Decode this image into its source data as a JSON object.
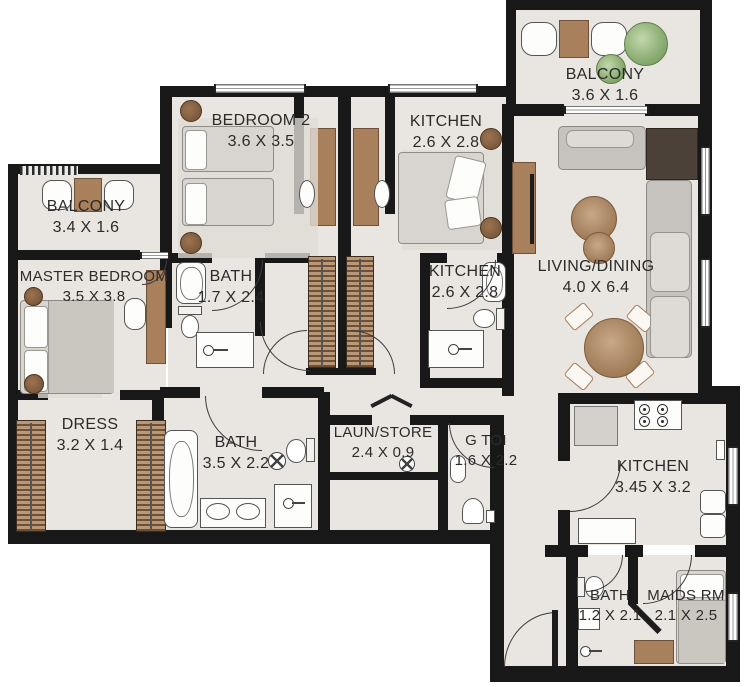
{
  "rooms": {
    "balcony_top": {
      "name": "BALCONY",
      "dims": "3.6 X 1.6"
    },
    "bedroom2": {
      "name": "BEDROOM 2",
      "dims": "3.6 X 3.5"
    },
    "kitchen_top": {
      "name": "KITCHEN",
      "dims": "2.6 X 2.8"
    },
    "balcony_left": {
      "name": "BALCONY",
      "dims": "3.4 X 1.6"
    },
    "master": {
      "name": "MASTER BEDROOM",
      "dims": "3.5 X 3.8"
    },
    "bath_master": {
      "name": "BATH",
      "dims": "1.7 X 2.4"
    },
    "kitchen_mid": {
      "name": "KITCHEN",
      "dims": "2.6 X 2.8"
    },
    "living": {
      "name": "LIVING/DINING",
      "dims": "4.0 X 6.4"
    },
    "dress": {
      "name": "DRESS",
      "dims": "3.2 X 1.4"
    },
    "bath_main": {
      "name": "BATH",
      "dims": "3.5 X 2.2"
    },
    "laun": {
      "name": "LAUN/STORE",
      "dims": "2.4 X 0.9"
    },
    "g_toi": {
      "name": "G TOI",
      "dims": "1.6 X 2.2"
    },
    "kitchen_main": {
      "name": "KITCHEN",
      "dims": "3.45 X 3.2"
    },
    "bath_maids": {
      "name": "BATH",
      "dims": "1.2 X 2.1"
    },
    "maids": {
      "name": "MAIDS RM",
      "dims": "2.1 X 2.5"
    }
  },
  "colors": {
    "wall": "#181818",
    "floor": "#e9e6e1",
    "wood": "#a9805c",
    "plant_green": "#8fb077",
    "sofa_gray": "#c6c3be"
  }
}
